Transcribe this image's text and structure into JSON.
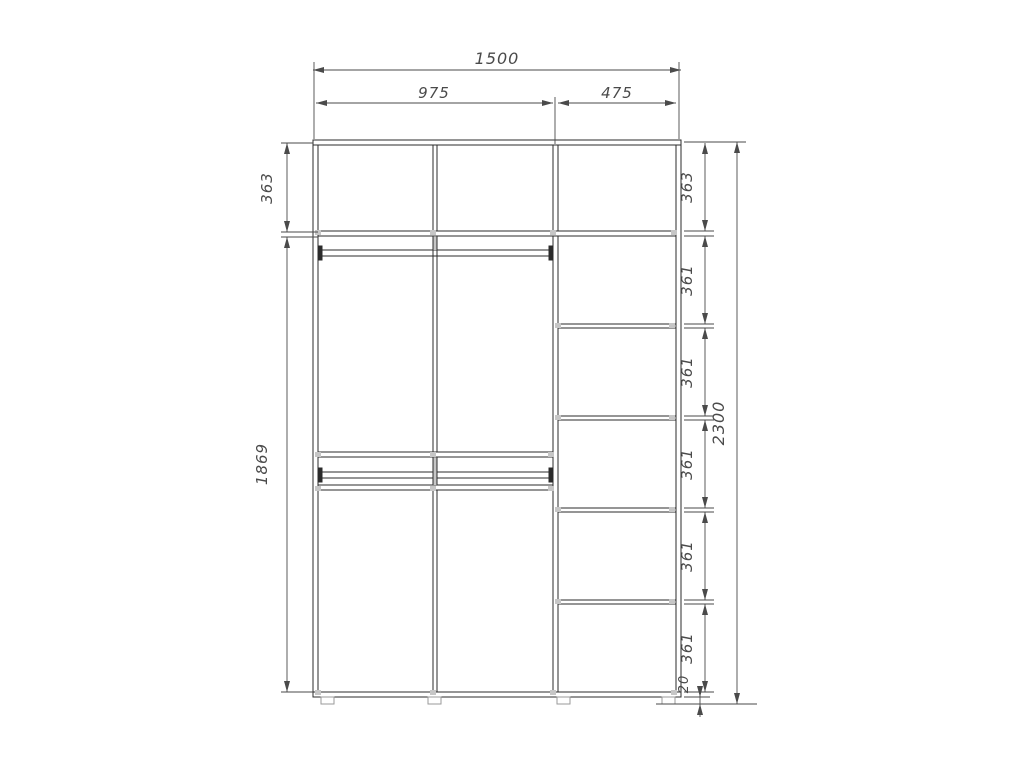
{
  "dims": {
    "width_total": "1500",
    "width_left": "975",
    "width_right": "475",
    "height_total": "2300",
    "left_heights": [
      "363",
      "1869"
    ],
    "right_heights": [
      "363",
      "361",
      "361",
      "361",
      "361",
      "361"
    ],
    "plinth": "20"
  },
  "colors": {
    "cabinet_line": "#2b2b2b",
    "dimension_line": "#4a4a4a",
    "connector_grey": "#c6c6c6",
    "foot_grey": "#9a9a9a",
    "background": "#ffffff"
  }
}
